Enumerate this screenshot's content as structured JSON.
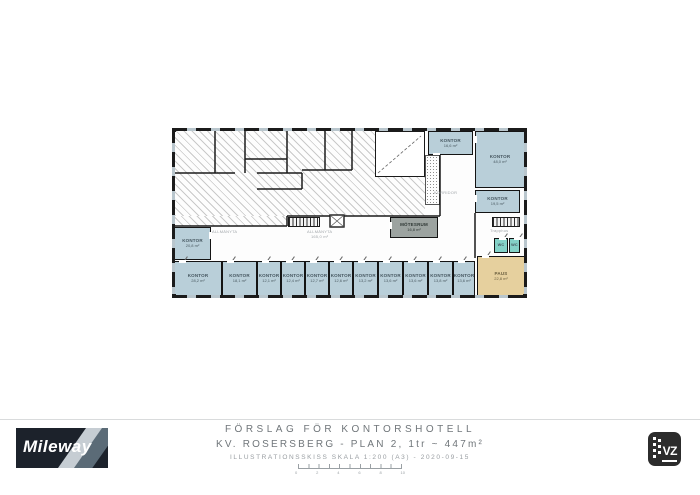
{
  "title_block": {
    "line1": "FÖRSLAG FÖR KONTORSHOTELL",
    "line2": "KV. ROSERSBERG - PLAN 2, 1tr ~ 447m²",
    "line3": "ILLUSTRATIONSSKISS SKALA 1:200 (A3) - 2020-09-15",
    "scale_labels": [
      "0",
      "2",
      "4",
      "6",
      "8",
      "10"
    ]
  },
  "branding": {
    "mileway": "Mileway",
    "viz": "VZ"
  },
  "floorplan": {
    "colors": {
      "office": "#b9cfd9",
      "wc": "#84d2c8",
      "pause": "#e6d09e",
      "meeting": "#9ca3a0",
      "wall": "#1b1b1b"
    },
    "rooms": [
      {
        "id": "kontor-vast",
        "label": "KONTOR",
        "area": "20,8 m²",
        "type": "office",
        "x": 2,
        "y": 99,
        "w": 37,
        "h": 33,
        "door": "right"
      },
      {
        "id": "kontor-b1",
        "label": "KONTOR",
        "area": "28,2 m²",
        "type": "office",
        "x": 2,
        "y": 133,
        "w": 48,
        "h": 35,
        "door": "top"
      },
      {
        "id": "kontor-b2",
        "label": "KONTOR",
        "area": "18,1 m²",
        "type": "office",
        "x": 50,
        "y": 133,
        "w": 35,
        "h": 35,
        "door": "top"
      },
      {
        "id": "kontor-b3",
        "label": "KONTOR",
        "area": "12,1 m²",
        "type": "office",
        "x": 85,
        "y": 133,
        "w": 24,
        "h": 35,
        "door": "top"
      },
      {
        "id": "kontor-b4",
        "label": "KONTOR",
        "area": "12,4 m²",
        "type": "office",
        "x": 109,
        "y": 133,
        "w": 24,
        "h": 35,
        "door": "top"
      },
      {
        "id": "kontor-b5",
        "label": "KONTOR",
        "area": "12,7 m²",
        "type": "office",
        "x": 133,
        "y": 133,
        "w": 24,
        "h": 35,
        "door": "top"
      },
      {
        "id": "kontor-b6",
        "label": "KONTOR",
        "area": "12,6 m²",
        "type": "office",
        "x": 157,
        "y": 133,
        "w": 24,
        "h": 35,
        "door": "top"
      },
      {
        "id": "kontor-b7",
        "label": "KONTOR",
        "area": "13,2 m²",
        "type": "office",
        "x": 181,
        "y": 133,
        "w": 25,
        "h": 35,
        "door": "top"
      },
      {
        "id": "kontor-b8",
        "label": "KONTOR",
        "area": "13,6 m²",
        "type": "office",
        "x": 206,
        "y": 133,
        "w": 25,
        "h": 35,
        "door": "top"
      },
      {
        "id": "kontor-b9",
        "label": "KONTOR",
        "area": "13,6 m²",
        "type": "office",
        "x": 231,
        "y": 133,
        "w": 25,
        "h": 35,
        "door": "top"
      },
      {
        "id": "kontor-b10",
        "label": "KONTOR",
        "area": "13,8 m²",
        "type": "office",
        "x": 256,
        "y": 133,
        "w": 25,
        "h": 35,
        "door": "top"
      },
      {
        "id": "kontor-b11",
        "label": "KONTOR",
        "area": "13,6 m²",
        "type": "office",
        "x": 281,
        "y": 133,
        "w": 22,
        "h": 35,
        "door": "top"
      },
      {
        "id": "kontor-norr",
        "label": "KONTOR",
        "area": "16,6 m²",
        "type": "office",
        "x": 256,
        "y": 3,
        "w": 45,
        "h": 24,
        "door": "bottom"
      },
      {
        "id": "kontor-ost-stor",
        "label": "KONTOR",
        "area": "48,0 m²",
        "type": "office",
        "x": 303,
        "y": 3,
        "w": 50,
        "h": 57,
        "door": "left"
      },
      {
        "id": "kontor-ost",
        "label": "KONTOR",
        "area": "19,5 m²",
        "type": "office",
        "x": 303,
        "y": 62,
        "w": 45,
        "h": 23,
        "door": "left"
      },
      {
        "id": "motesrum",
        "label": "MÖTESRUM",
        "area": "16,8 m²",
        "type": "meeting",
        "x": 218,
        "y": 89,
        "w": 48,
        "h": 21,
        "door": "left"
      },
      {
        "id": "wc-1",
        "label": "WC",
        "area": "",
        "type": "wc",
        "x": 322,
        "y": 110,
        "w": 14,
        "h": 15,
        "door": "top"
      },
      {
        "id": "wc-2",
        "label": "WC",
        "area": "",
        "type": "wc",
        "x": 337,
        "y": 110,
        "w": 11,
        "h": 15,
        "door": "top"
      },
      {
        "id": "paus",
        "label": "PAUS",
        "area": "22,8 m²",
        "type": "pause",
        "x": 305,
        "y": 128,
        "w": 48,
        "h": 40,
        "door": "top"
      }
    ],
    "corridor_labels": [
      {
        "line1": "ALLMÄNYTA",
        "line2": "",
        "x": 40,
        "y": 101
      },
      {
        "line1": "ALLMÄNYTA",
        "line2": "165,0 m²",
        "x": 135,
        "y": 101
      },
      {
        "line1": "KORRIDOR",
        "line2": "",
        "x": 262,
        "y": 62
      },
      {
        "line1": "Trapphus",
        "line2": "",
        "x": 318,
        "y": 100
      }
    ]
  }
}
